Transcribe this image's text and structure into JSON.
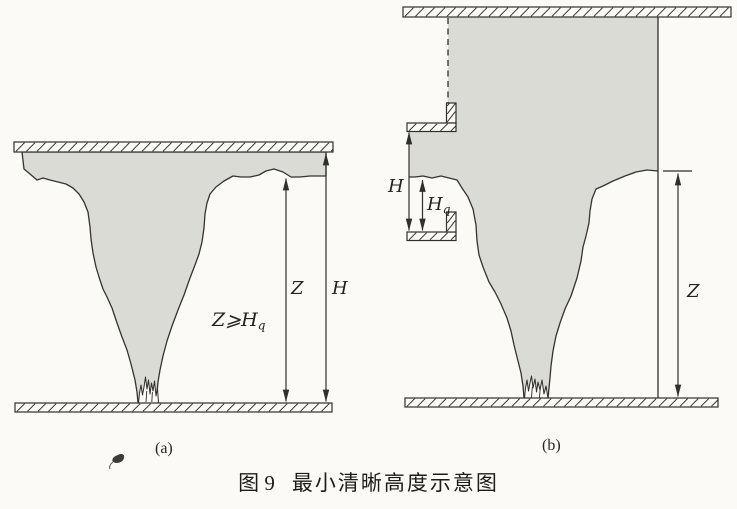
{
  "figure": {
    "type": "schematic-diagram",
    "colors": {
      "paper": "#fbfaf6",
      "smoke_fill": "#d9dbd4",
      "line": "#2f2f2b"
    }
  },
  "panel_a": {
    "label": "(a)",
    "z_label": "Z",
    "h_label": "H",
    "condition": {
      "main": "Z⩾H",
      "sub": "q"
    }
  },
  "panel_b": {
    "label": "(b)",
    "h_label": "H",
    "hq": {
      "main": "H",
      "sub": "q"
    },
    "z_label": "Z"
  },
  "caption": {
    "figure_no": "图 9",
    "title": "最小清晰高度示意图"
  }
}
